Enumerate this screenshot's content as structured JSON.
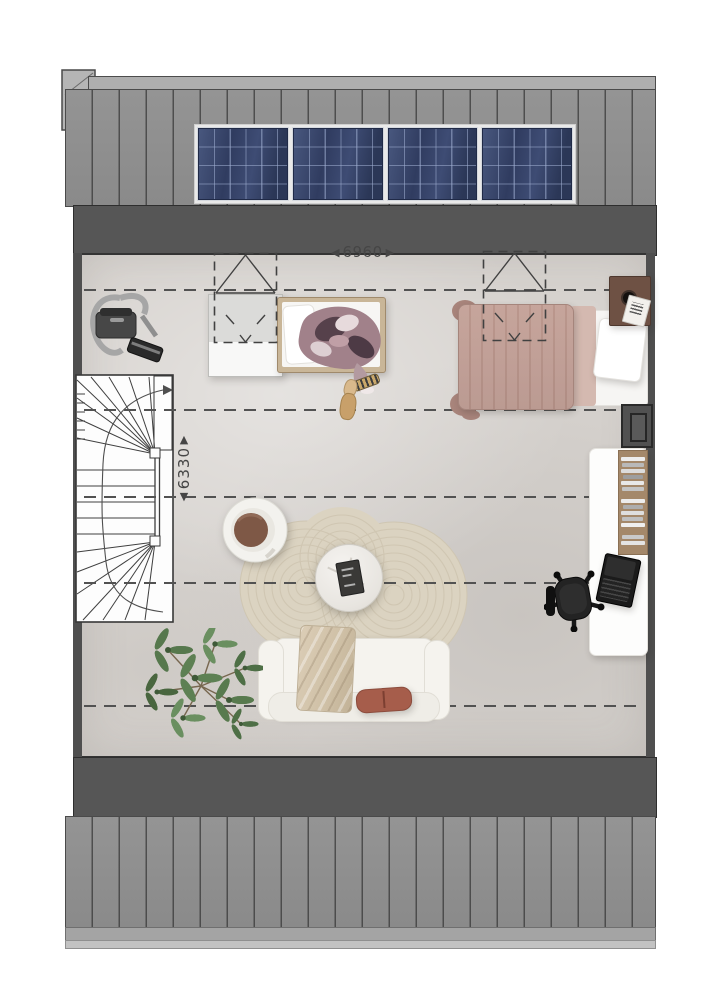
{
  "plan": {
    "type": "attic-floor-plan",
    "dimension_width": {
      "arrow_left": "◀",
      "value": "6960",
      "arrow_right": "▶"
    },
    "dimension_depth": {
      "arrow_up": "▲",
      "value": "6330",
      "arrow_down": "▼"
    },
    "solar_panel_count": 4,
    "skylight_count": 2,
    "dashed_guide_lines": 5,
    "colors": {
      "roof": "#8e8e8e",
      "ridge": "#aeaeae",
      "wall_band": "#565656",
      "floor": "#d7d3cf",
      "solar_panel": "#32405f",
      "rug": "#dbd3c1",
      "double_bed_duvet": "#bd9a90",
      "wood_shelf": "#a4886a",
      "sofa": "#f5f3ee",
      "accent_pillow": "#a65d4b",
      "plant": "#5d8053",
      "guide_line": "#525252"
    },
    "furniture": [
      "staircase",
      "vacuum-cleaner",
      "dresser",
      "single-bed",
      "double-bed",
      "nightstand",
      "duct",
      "desk",
      "bookshelf",
      "laptop",
      "office-chair",
      "armchair",
      "coffee-table",
      "rug",
      "sofa",
      "plant"
    ]
  }
}
